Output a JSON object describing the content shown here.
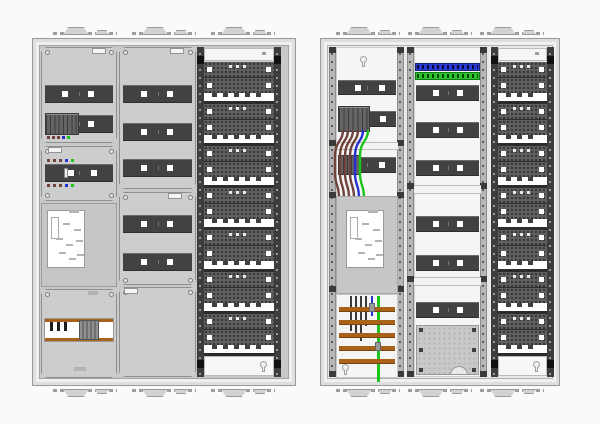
{
  "diagram": {
    "name": "electrical-distribution-cabinet-drawings",
    "views": [
      {
        "id": "left",
        "label": "cabinet-with-covers-and-devices"
      },
      {
        "id": "right",
        "label": "cabinet-internal-wiring-view"
      }
    ],
    "colors": {
      "canvas_bg": "#fafafa",
      "shell": "#f0f0f0",
      "shell_border": "#9a9a9a",
      "interior_left": "#c9c9c9",
      "interior_right": "#e9e9e9",
      "cover": "#cdcdcd",
      "cover_border": "#8f8f8f",
      "rail_dark": "#424242",
      "rail_square": "#ffffff",
      "module": "#646464",
      "perf_panel": "#5f5f5f",
      "perf_hole": "#333333",
      "perf_frame": "#2c2c2c",
      "side_rail_dark": "#3d3d3d",
      "side_rail_light": "#b6b6b6",
      "comb_white": "#ffffff",
      "comb_tooth": "#3f3f3f",
      "busbar_orange": "#a8621a",
      "wire_brown": "#6f433b",
      "wire_blue": "#2730cf",
      "wire_green": "#1cc41c",
      "wire_black": "#3a3a3a",
      "terminal_blue": "#2b3bd6",
      "terminal_green": "#2cc22c",
      "meter_plate": "#ffffff",
      "meter_backing": "#c6c6c6",
      "plate_gray": "#c9c9c9"
    },
    "left_cabinet": {
      "knockout_groups": 3,
      "column1": {
        "section1": {
          "rails": 2,
          "module_count": 8,
          "module_marks": [
            "brown",
            "brown",
            "brown",
            "blue",
            "green"
          ]
        },
        "section2": {
          "rails": 1,
          "marks_above": [
            "brown",
            "brown",
            "brown",
            "blue",
            "green"
          ],
          "marks_below": [
            "brown",
            "brown",
            "brown",
            "blue",
            "green"
          ]
        },
        "section3": {
          "component": "meter-mounting-plate"
        },
        "section4": {
          "component": "busbar-terminal-cover",
          "prongs": 3
        }
      },
      "column2": {
        "section1_rails": 3,
        "section2_rails": 2,
        "section3": "blank-cover"
      },
      "column3": {
        "panel_units": 7
      }
    },
    "right_cabinet": {
      "knockout_groups": 3,
      "column1": {
        "top_rails": 2,
        "module_count": 7,
        "wires": [
          "brown",
          "brown",
          "brown",
          "brown",
          "blue",
          "green"
        ],
        "busbars": 5,
        "busbar_black_wire_lengths": [
          35,
          40,
          45,
          30
        ],
        "component": "meter-mounting-plate"
      },
      "column2": {
        "terminal_strips": [
          "blue",
          "green"
        ],
        "rail_rows": 6,
        "bottom_plate": "perforated-mounting-plate"
      },
      "column3": {
        "panel_units": 7
      }
    }
  }
}
